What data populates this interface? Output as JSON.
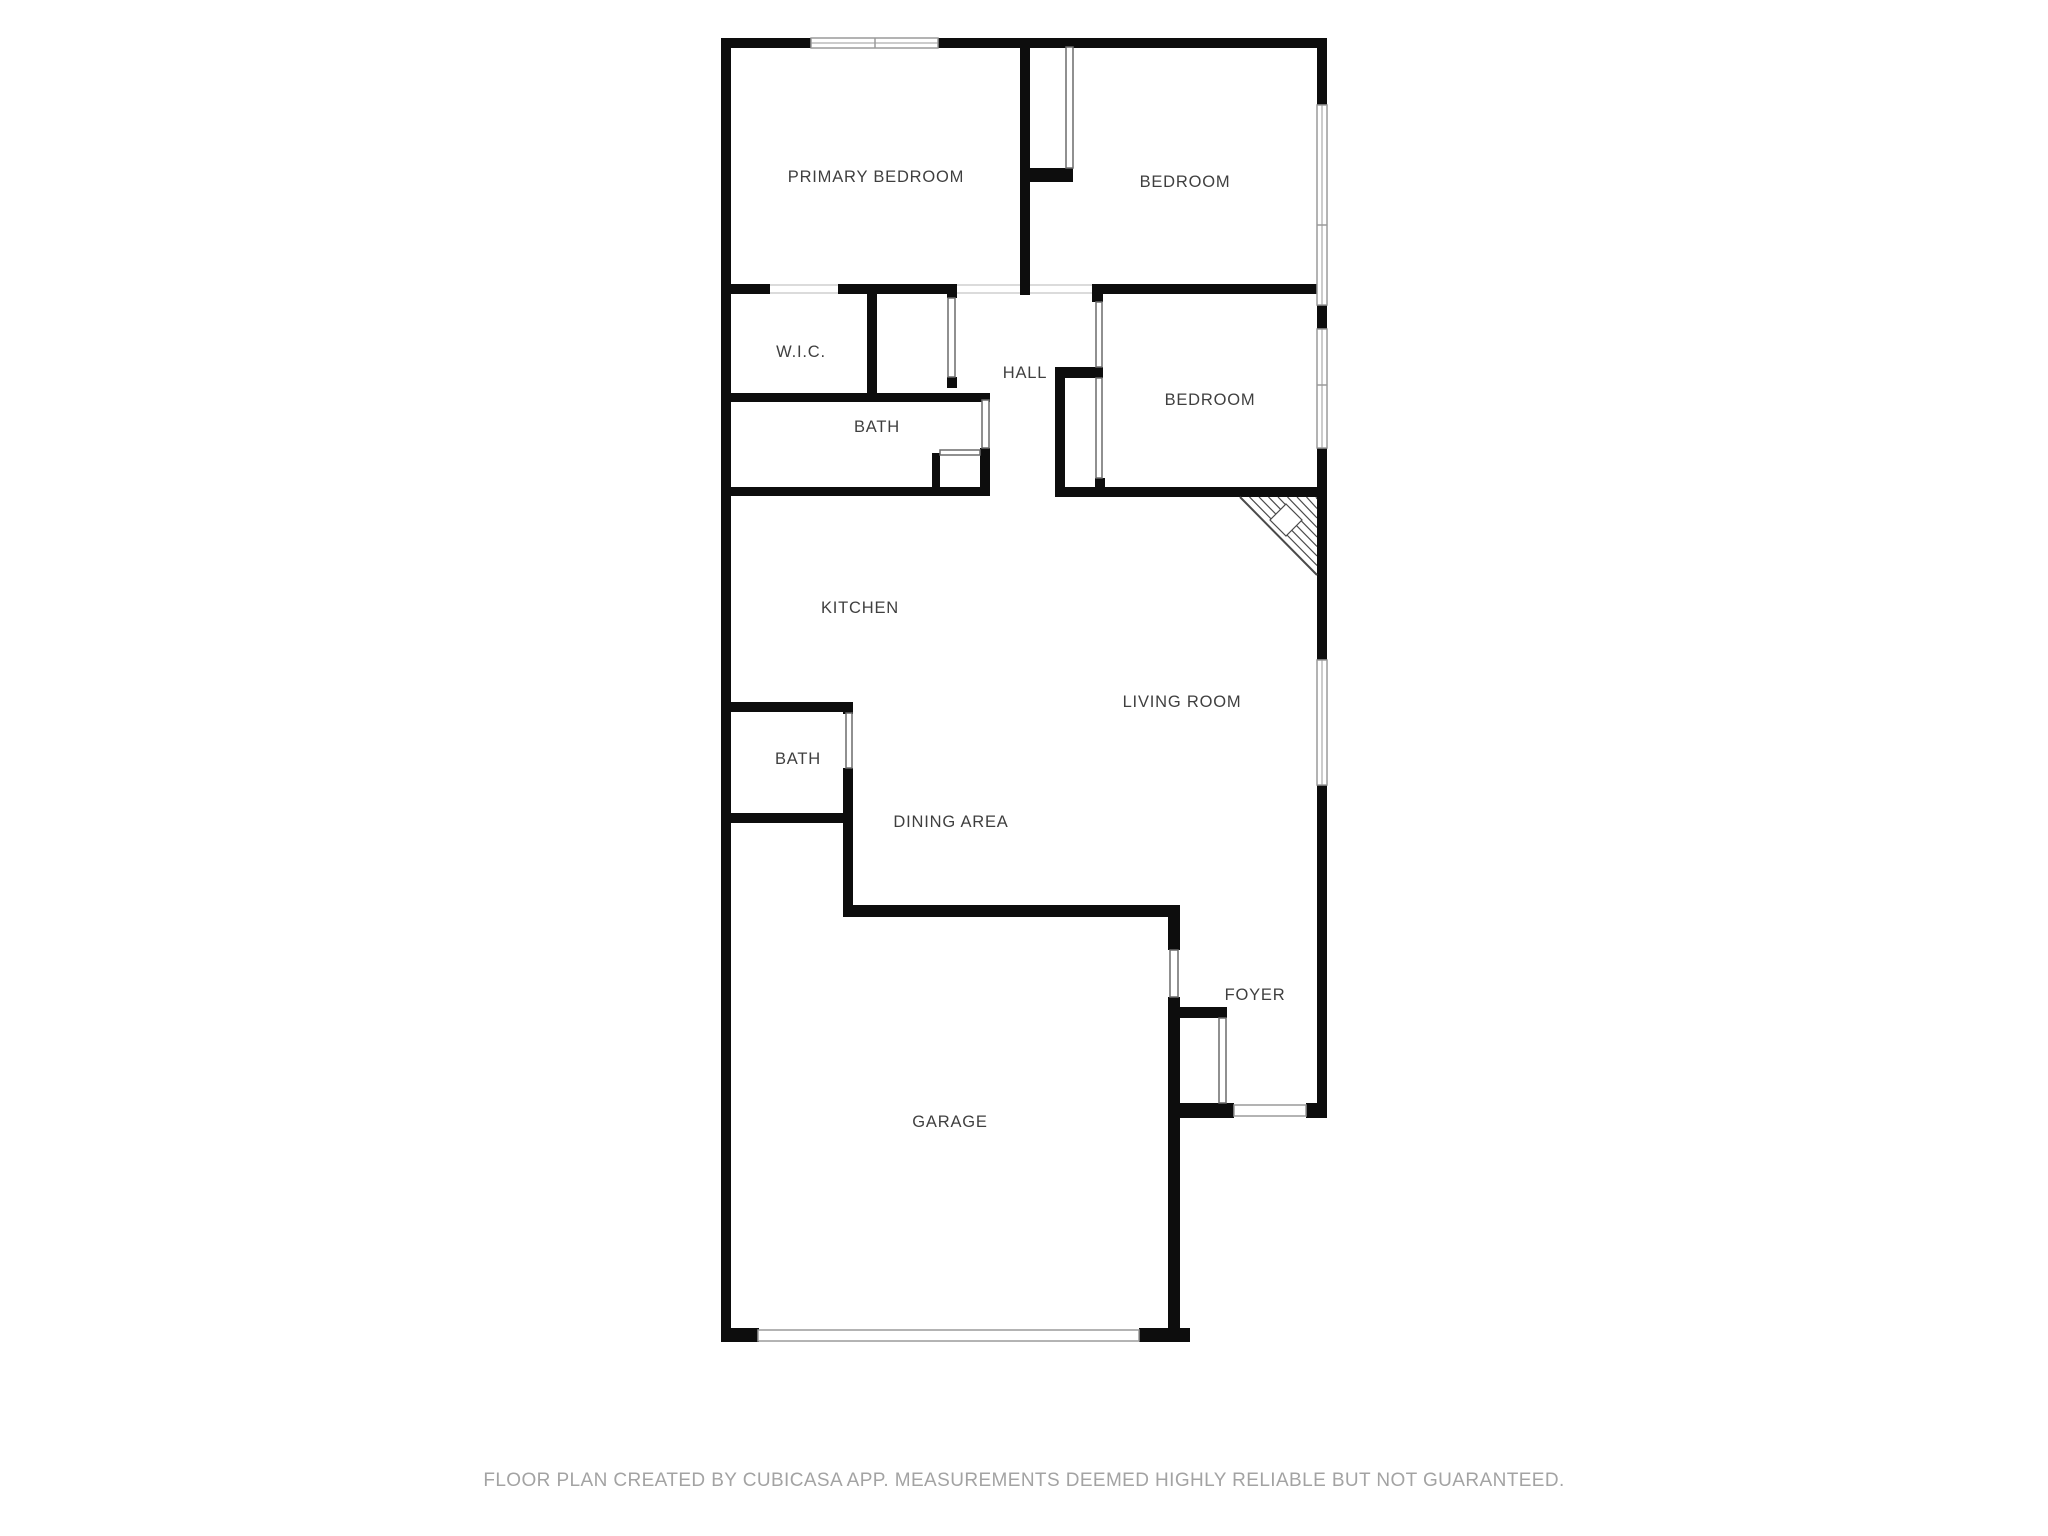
{
  "page": {
    "background": "#ffffff"
  },
  "footer": {
    "text": "FLOOR PLAN CREATED BY CUBICASA APP. MEASUREMENTS DEEMED HIGHLY RELIABLE BUT NOT GUARANTEED."
  },
  "palette": {
    "wall": "#0d0d0d",
    "label": "#3f3f3f",
    "footer_text": "#a3a3a3",
    "window_frame": "#9a9a9a",
    "door_leaf": "#6b6b6b",
    "jamb": "#cfcfcf",
    "hatch": "#4a4a4a",
    "bg": "#ffffff"
  },
  "plan": {
    "canvas": {
      "width": 2048,
      "height": 1536
    },
    "labels": [
      {
        "id": "primary-bedroom",
        "text": "PRIMARY BEDROOM",
        "x": 876,
        "y": 182
      },
      {
        "id": "bedroom-top",
        "text": "BEDROOM",
        "x": 1185,
        "y": 187
      },
      {
        "id": "wic",
        "text": "W.I.C.",
        "x": 801,
        "y": 357
      },
      {
        "id": "hall",
        "text": "HALL",
        "x": 1025,
        "y": 378
      },
      {
        "id": "bedroom-middle",
        "text": "BEDROOM",
        "x": 1210,
        "y": 405
      },
      {
        "id": "bath-upper",
        "text": "BATH",
        "x": 877,
        "y": 432
      },
      {
        "id": "kitchen",
        "text": "KITCHEN",
        "x": 860,
        "y": 613
      },
      {
        "id": "living-room",
        "text": "LIVING ROOM",
        "x": 1182,
        "y": 707
      },
      {
        "id": "bath-lower",
        "text": "BATH",
        "x": 798,
        "y": 764
      },
      {
        "id": "dining-area",
        "text": "DINING AREA",
        "x": 951,
        "y": 827
      },
      {
        "id": "foyer",
        "text": "FOYER",
        "x": 1255,
        "y": 1000
      },
      {
        "id": "garage",
        "text": "GARAGE",
        "x": 950,
        "y": 1127
      }
    ],
    "walls": [
      [
        721,
        38,
        10,
        1304
      ],
      [
        721,
        38,
        90,
        10
      ],
      [
        938,
        38,
        389,
        10
      ],
      [
        1317,
        38,
        10,
        70
      ],
      [
        1317,
        305,
        10,
        24
      ],
      [
        1317,
        448,
        10,
        212
      ],
      [
        1317,
        785,
        10,
        333
      ],
      [
        721,
        1328,
        38,
        14
      ],
      [
        1139,
        1328,
        51,
        14
      ],
      [
        1170,
        1103,
        64,
        15
      ],
      [
        1306,
        1103,
        21,
        15
      ],
      [
        721,
        284,
        49,
        10
      ],
      [
        838,
        284,
        109,
        10
      ],
      [
        947,
        284,
        10,
        14
      ],
      [
        1092,
        284,
        235,
        10
      ],
      [
        1020,
        48,
        10,
        247
      ],
      [
        1020,
        168,
        53,
        14
      ],
      [
        867,
        294,
        10,
        106
      ],
      [
        947,
        377,
        10,
        11
      ],
      [
        721,
        393,
        269,
        9
      ],
      [
        980,
        448,
        10,
        47
      ],
      [
        721,
        487,
        269,
        9
      ],
      [
        932,
        453,
        8,
        42
      ],
      [
        1055,
        367,
        10,
        130
      ],
      [
        1055,
        367,
        48,
        11
      ],
      [
        1092,
        294,
        11,
        8
      ],
      [
        1093,
        367,
        10,
        11
      ],
      [
        1095,
        478,
        10,
        14
      ],
      [
        1055,
        487,
        272,
        10
      ],
      [
        721,
        702,
        132,
        10
      ],
      [
        721,
        813,
        132,
        10
      ],
      [
        843,
        702,
        10,
        12
      ],
      [
        843,
        768,
        10,
        149
      ],
      [
        843,
        905,
        337,
        12
      ],
      [
        1168,
        917,
        12,
        33
      ],
      [
        1168,
        997,
        12,
        345
      ],
      [
        1180,
        1007,
        47,
        11
      ]
    ],
    "door_leaves": [
      [
        1066,
        47,
        7,
        121
      ],
      [
        948,
        298,
        7,
        79
      ],
      [
        982,
        400,
        7,
        48
      ],
      [
        940,
        450,
        40,
        5
      ],
      [
        1096,
        302,
        6,
        65
      ],
      [
        1096,
        378,
        6,
        100
      ],
      [
        846,
        713,
        6,
        55
      ],
      [
        1170,
        950,
        8,
        47
      ],
      [
        1219,
        1018,
        7,
        85
      ]
    ],
    "windows": [
      {
        "x": 811,
        "y": 38,
        "w": 127,
        "h": 10,
        "orient": "h",
        "divisions": [
          875
        ]
      },
      {
        "x": 1317,
        "y": 105,
        "w": 10,
        "h": 200,
        "orient": "v",
        "divisions": [
          225
        ]
      },
      {
        "x": 1317,
        "y": 329,
        "w": 10,
        "h": 119,
        "orient": "v",
        "divisions": [
          385
        ]
      },
      {
        "x": 1317,
        "y": 660,
        "w": 10,
        "h": 125,
        "orient": "v",
        "divisions": []
      }
    ],
    "garage_door": {
      "x": 758,
      "y": 1330,
      "w": 381,
      "h": 11
    },
    "front_door": {
      "x": 1234,
      "y": 1105,
      "w": 72,
      "h": 11
    },
    "wall_openings": [
      {
        "x1": 770,
        "x2": 838,
        "y": 284,
        "h": 10
      },
      {
        "x1": 957,
        "x2": 1020,
        "y": 284,
        "h": 10
      },
      {
        "x1": 1030,
        "x2": 1092,
        "y": 284,
        "h": 10
      }
    ],
    "corner_hatch": {
      "triangle": [
        [
          1240,
          497
        ],
        [
          1317,
          497
        ],
        [
          1317,
          575
        ]
      ],
      "line_count": 8,
      "line_spacing": 9.5,
      "diamond": {
        "cx": 1286,
        "cy": 520,
        "r": 16
      }
    }
  }
}
